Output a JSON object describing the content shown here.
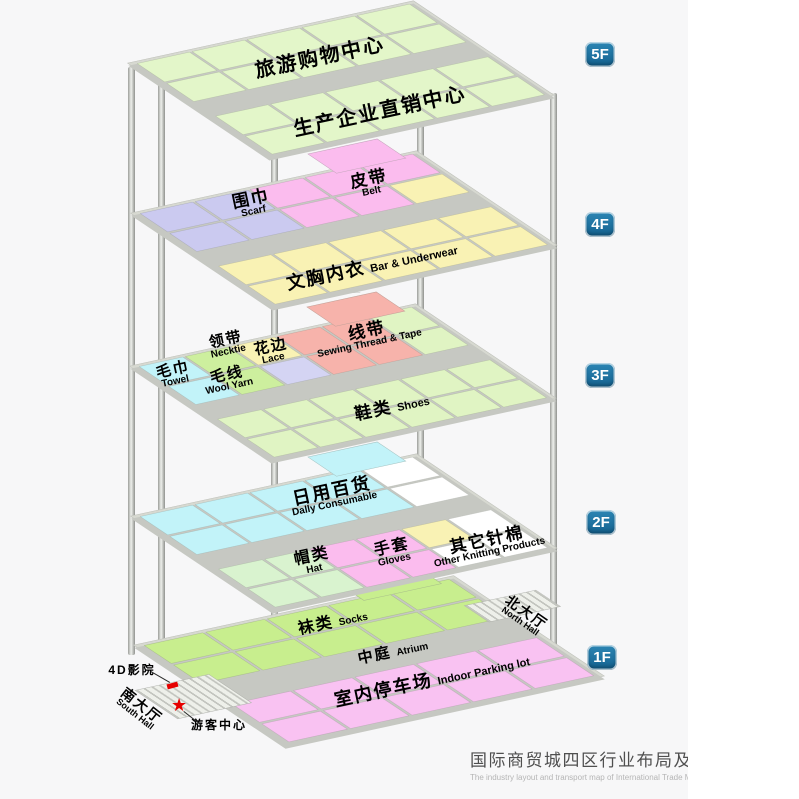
{
  "palette": {
    "g": "#e3f6c9",
    "v": "#cbcaf0",
    "p": "#fbbcee",
    "y": "#f9f2b4",
    "n": "#cdef9e",
    "l": "#d4d4f3",
    "s": "#f7b3ab",
    "e": "#e0f4c3",
    "c": "#c2f3f9",
    "h": "#d9f3cf",
    "w": "#ffffff",
    "k": "#c8ee8e",
    "q": "#f9c2f2"
  },
  "colors": {
    "badge_blue": "#13618f",
    "figure_bg": "#f7f7f8",
    "slab_gray": "#d7d9d1",
    "marker_red": "#e60000"
  },
  "floor_badges": [
    {
      "label": "5F"
    },
    {
      "label": "4F"
    },
    {
      "label": "3F"
    },
    {
      "label": "2F"
    },
    {
      "label": "1F"
    }
  ],
  "floors": [
    {
      "name": "5F",
      "protrusion": null,
      "tiles": {
        "top": [
          "ggggg",
          "ggggg"
        ],
        "bottom": [
          "ggggg",
          "ggggg"
        ]
      }
    },
    {
      "name": "4F",
      "protrusion": "p",
      "tiles": {
        "top": [
          "vvppp",
          "vvppy"
        ],
        "bottom": [
          "yyyyy",
          "yyyyy"
        ]
      }
    },
    {
      "name": "3F",
      "protrusion": "s",
      "tiles": {
        "top": [
          "cnysse",
          "cnlsse"
        ],
        "bottom": [
          "eeeeee",
          "eeeeee"
        ]
      }
    },
    {
      "name": "2F",
      "protrusion": "c",
      "tiles": {
        "top": [
          "ccccw",
          "ccccw"
        ],
        "bottom": [
          "hhppyw",
          "hhppww"
        ]
      }
    },
    {
      "name": "1F",
      "protrusion": "k",
      "tiles": {
        "top": [
          "kkkkk",
          "kkkkk"
        ],
        "bottom": [
          "qqqqq",
          "qqqqq"
        ]
      }
    }
  ],
  "labels": [
    {
      "id": "tour-shopping-center",
      "zh": "旅游购物中心",
      "en": "",
      "x": 320,
      "y": 58,
      "rot": -12,
      "zhSize": 20
    },
    {
      "id": "direct-sales-center",
      "zh": "生产企业直销中心",
      "en": "",
      "x": 380,
      "y": 112,
      "rot": -12,
      "zhSize": 20
    },
    {
      "id": "scarf",
      "zh": "围巾",
      "en": "Scarf",
      "x": 252,
      "y": 204,
      "rot": -12,
      "zhSize": 17
    },
    {
      "id": "belt",
      "zh": "皮带",
      "en": "Belt",
      "x": 370,
      "y": 184,
      "rot": -12,
      "zhSize": 17
    },
    {
      "id": "bra-underwear",
      "zh": "文胸内衣",
      "en": "Bar & Underwear",
      "x": 372,
      "y": 266,
      "rot": -12,
      "zhSize": 18,
      "enSize": 11,
      "inline": true
    },
    {
      "id": "sewing-thread-tape",
      "zh": "线带",
      "en": "Sewing Thread & Tape",
      "x": 368,
      "y": 336,
      "rot": -12,
      "zhSize": 17
    },
    {
      "id": "necktie",
      "zh": "领带",
      "en": "Necktie",
      "x": 227,
      "y": 345,
      "rot": -12,
      "zhSize": 15
    },
    {
      "id": "lace",
      "zh": "花边",
      "en": "Lace",
      "x": 272,
      "y": 352,
      "rot": -12,
      "zhSize": 15
    },
    {
      "id": "towel",
      "zh": "毛巾",
      "en": "Towel",
      "x": 174,
      "y": 375,
      "rot": -12,
      "zhSize": 15
    },
    {
      "id": "wool-yarn",
      "zh": "毛线",
      "en": "Wool Yarn",
      "x": 228,
      "y": 380,
      "rot": -12,
      "zhSize": 15
    },
    {
      "id": "shoes",
      "zh": "鞋类",
      "en": "Shoes",
      "x": 392,
      "y": 407,
      "rot": -12,
      "zhSize": 17,
      "enSize": 11,
      "inline": true
    },
    {
      "id": "daily-consumable",
      "zh": "日用百货",
      "en": "Dally Consumable",
      "x": 333,
      "y": 496,
      "rot": -12,
      "zhSize": 18
    },
    {
      "id": "hat",
      "zh": "帽类",
      "en": "Hat",
      "x": 313,
      "y": 562,
      "rot": -12,
      "zhSize": 16
    },
    {
      "id": "gloves",
      "zh": "手套",
      "en": "Gloves",
      "x": 393,
      "y": 553,
      "rot": -12,
      "zhSize": 16
    },
    {
      "id": "other-knitting",
      "zh": "其它针棉",
      "en": "Other Knitting Products",
      "x": 488,
      "y": 545,
      "rot": -12,
      "zhSize": 17
    },
    {
      "id": "socks",
      "zh": "袜类",
      "en": "Socks",
      "x": 333,
      "y": 623,
      "rot": -12,
      "zhSize": 16,
      "enSize": 10,
      "inline": true
    },
    {
      "id": "atrium",
      "zh": "中庭",
      "en": "Atrium",
      "x": 393,
      "y": 652,
      "rot": -12,
      "zhSize": 15,
      "enSize": 10,
      "inline": true
    },
    {
      "id": "indoor-parking",
      "zh": "室内停车场",
      "en": "Indoor Parking lot",
      "x": 432,
      "y": 680,
      "rot": -12,
      "zhSize": 18,
      "enSize": 11,
      "inline": true
    },
    {
      "id": "north-hall",
      "zh": "北大厅",
      "en": "North Hall",
      "x": 524,
      "y": 616,
      "rot": 35,
      "zhSize": 14,
      "enSize": 9
    },
    {
      "id": "south-hall",
      "zh": "南大厅",
      "en": "South Hall",
      "x": 139,
      "y": 709,
      "rot": 38,
      "zhSize": 14,
      "enSize": 9
    },
    {
      "id": "cinema-4d",
      "zh": "4D影院",
      "en": "",
      "x": 132,
      "y": 670,
      "rot": 0,
      "zhSize": 12
    },
    {
      "id": "visitor-center",
      "zh": "游客中心",
      "en": "",
      "x": 219,
      "y": 725,
      "rot": 0,
      "zhSize": 12
    }
  ],
  "markers": {
    "visitor_star_glyph": "★"
  },
  "caption": {
    "title": "国际商贸城四区行业布局及交通图",
    "subtitle": "The industry layout and transport map of International Trade Mart District Fo"
  }
}
